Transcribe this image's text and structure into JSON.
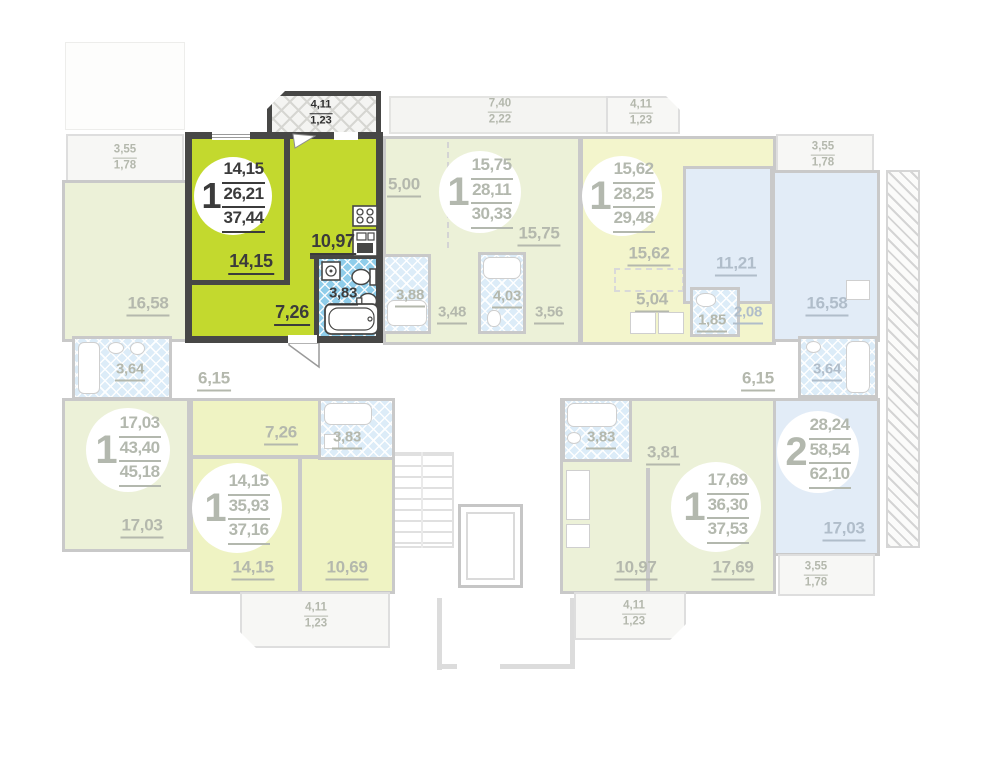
{
  "page": {
    "type": "residential floor plan",
    "background": "#ffffff"
  },
  "colors": {
    "highlight_fill": "#c3d92e",
    "highlight_wall": "#474746",
    "highlight_text": "#3b3b3b",
    "bath_tile_blue": "#8fcdea",
    "faded_wall": "#c9c9c9",
    "faded_text": "#b4b8ad",
    "pale_green": "#ecf1d8",
    "pale_yellow": "#f3f5cc",
    "pale_lime": "#eff3c3",
    "pale_blue": "#e2ecf7",
    "faded_tile": "#dcecf8"
  },
  "apartments": {
    "highlighted": {
      "badge": "1",
      "areas": [
        "14,15",
        "26,21",
        "37,44"
      ]
    },
    "top_middle": {
      "badge": "1",
      "areas": [
        "15,75",
        "28,11",
        "30,33"
      ]
    },
    "top_right": {
      "badge": "1",
      "areas": [
        "15,62",
        "28,25",
        "29,48"
      ]
    },
    "bottom_left": {
      "badge": "1",
      "areas": [
        "17,03",
        "43,40",
        "45,18"
      ]
    },
    "bottom_middle": {
      "badge": "1",
      "areas": [
        "14,15",
        "35,93",
        "37,16"
      ]
    },
    "bottom_right": {
      "badge": "1",
      "areas": [
        "17,69",
        "36,30",
        "37,53"
      ]
    },
    "right_two_room": {
      "badge": "2",
      "areas": [
        "28,24",
        "58,54",
        "62,10"
      ]
    }
  },
  "room_labels": {
    "hl_living": "14,15",
    "hl_kitchen": "10,97",
    "hl_hall": "7,26",
    "hl_bath": "3,83",
    "tl_room": "16,58",
    "tl_bath": "3,64",
    "tm_kitchen": "5,00",
    "tm_room": "15,75",
    "tm_bath_a": "3,88",
    "tm_hall_a": "3,48",
    "tm_bath_b": "4,03",
    "tm_hall_b": "3,56",
    "tr_room": "15,62",
    "tr_bedroom": "11,21",
    "tr_kitchen": "5,04",
    "tr_wc": "1,85",
    "tr_hall": "2,08",
    "r_room": "16,58",
    "r_bath": "3,64",
    "corridor_left": "6,15",
    "corridor_right": "6,15",
    "bl_room": "17,03",
    "bm_hall": "7,26",
    "bm_bath": "3,83",
    "bm_room": "14,15",
    "bm_kitchen": "10,69",
    "br_bath": "3,83",
    "br_hall": "3,81",
    "br_kitchen": "10,97",
    "br_room": "17,69",
    "r2_room": "17,03"
  },
  "balcony_labels": {
    "hl": [
      "4,11",
      "1,23"
    ],
    "top_left": [
      "3,55",
      "1,78"
    ],
    "top_middle": [
      "7,40",
      "2,22"
    ],
    "top_right": [
      "4,11",
      "1,23"
    ],
    "right_top": [
      "3,55",
      "1,78"
    ],
    "bottom_middle": [
      "4,11",
      "1,23"
    ],
    "bottom_right": [
      "4,11",
      "1,23"
    ],
    "right_bottom": [
      "3,55",
      "1,78"
    ]
  }
}
